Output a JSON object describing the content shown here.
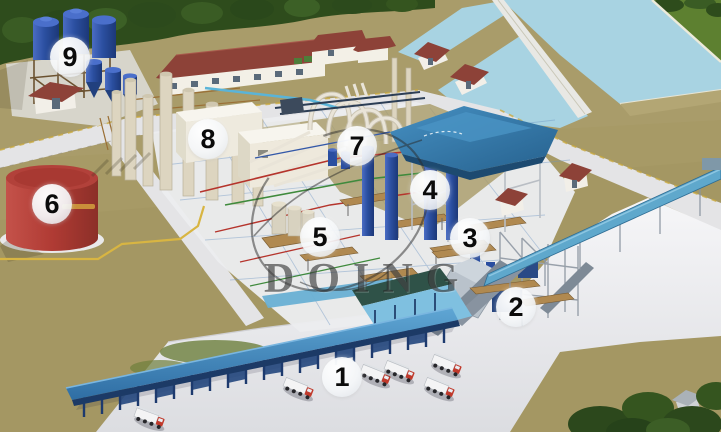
{
  "scene": {
    "watermark": {
      "text": "DOING"
    },
    "markers": [
      {
        "label": "1"
      },
      {
        "label": "2"
      },
      {
        "label": "3"
      },
      {
        "label": "4"
      },
      {
        "label": "5"
      },
      {
        "label": "6"
      },
      {
        "label": "7"
      },
      {
        "label": "8"
      },
      {
        "label": "9"
      }
    ],
    "palette": {
      "ground_tan": "#a79a66",
      "tree_green_dark": "#2e4c1c",
      "grass_green": "#5d8030",
      "pond_blue": "#a8d3e2",
      "concrete_floor": "#ebecee",
      "road_white": "#e4e4e6",
      "roof_red": "#8d4238",
      "press_canopy_roof_blue": "#3b82b4",
      "loading_canopy_blue": "#4e92c6",
      "column_navy": "#1d3a6e",
      "storage_tank_blue": "#2b4fa0",
      "oil_tank_red": "#b2413a",
      "truck_cab_red": "#c0392b",
      "pipe_yellow": "#d8b542",
      "watermark_gray": "#2b2b2b"
    }
  }
}
